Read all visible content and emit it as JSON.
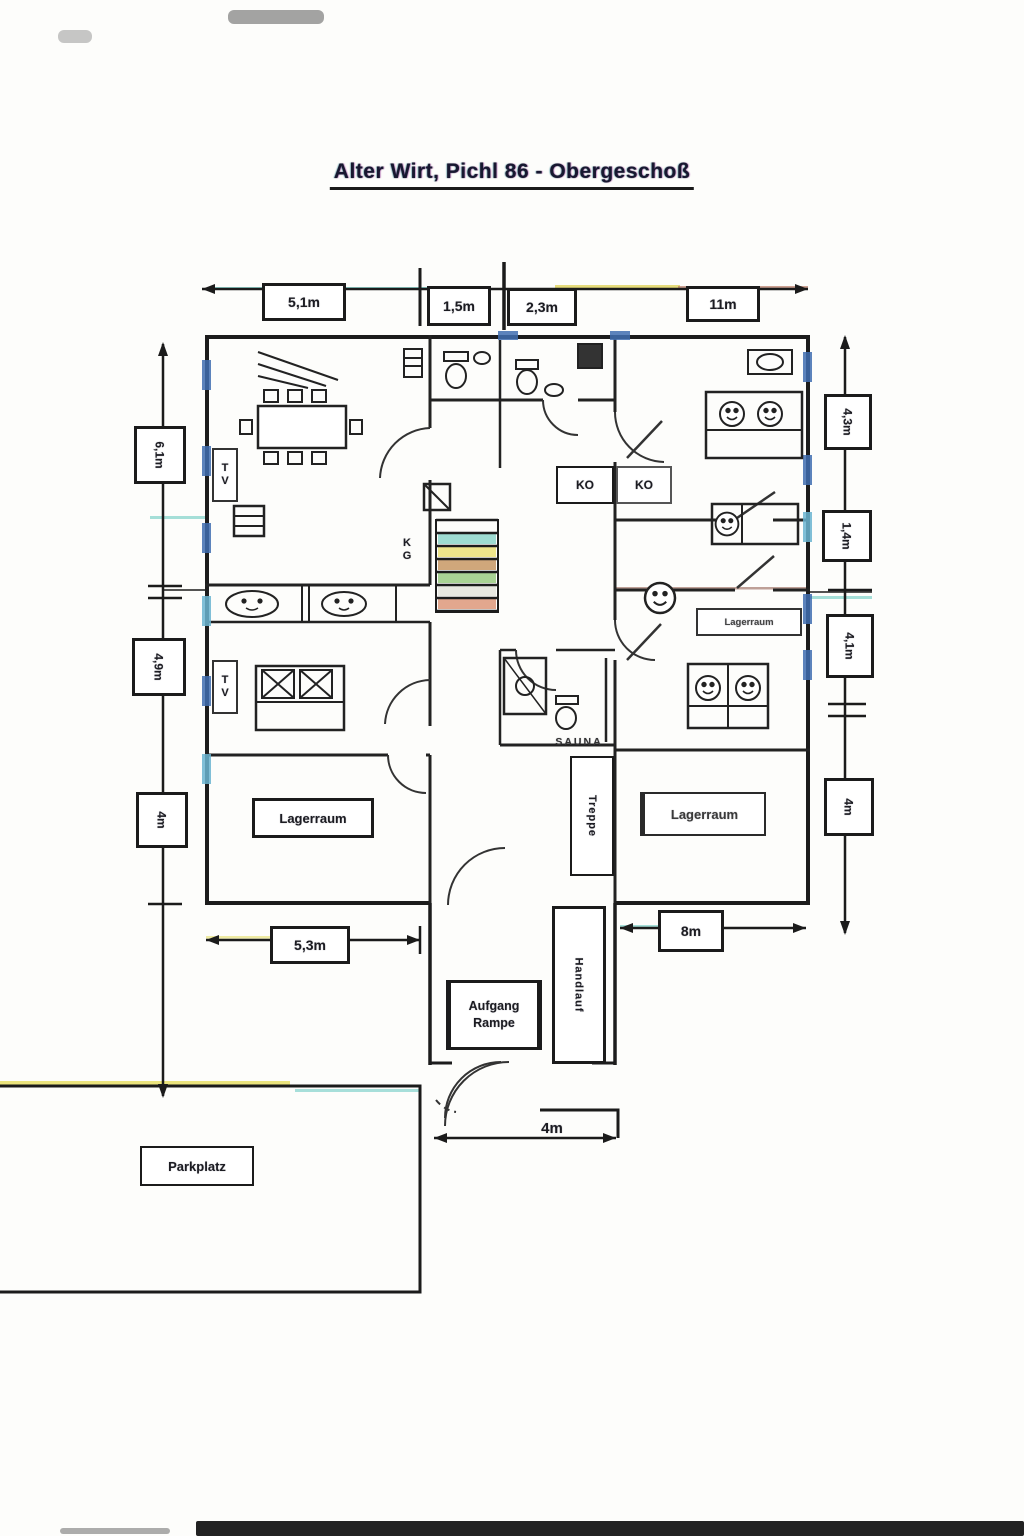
{
  "document": {
    "title": "Alter Wirt, Pichl 86 - Obergeschoß"
  },
  "dimensions": {
    "top": [
      {
        "label": "5,1m"
      },
      {
        "label": "1,5m"
      },
      {
        "label": "2,3m"
      },
      {
        "label": "11m"
      }
    ],
    "left": [
      {
        "label": "6,1m"
      },
      {
        "label": "4,9m"
      },
      {
        "label": "4m"
      }
    ],
    "right": [
      {
        "label": "4,3m"
      },
      {
        "label": "1,4m"
      },
      {
        "label": "4,1m"
      },
      {
        "label": "4m"
      }
    ],
    "bottom": {
      "left": "5,3m",
      "right": "8m",
      "ramp": "4m"
    }
  },
  "rooms": {
    "lagerraum_left": "Lagerraum",
    "lagerraum_right": "Lagerraum",
    "lagerraum_small": "Lagerraum",
    "sauna": "SAUNA",
    "treppe": "Treppe",
    "handlauf": "Handlauf",
    "aufgang": "Aufgang",
    "rampe": "Rampe",
    "parkplatz": "Parkplatz"
  },
  "annotations": {
    "ko_1": "KO",
    "ko_2": "KO",
    "tv_1": "TV",
    "tv_2": "TV",
    "kg": "KG"
  }
}
